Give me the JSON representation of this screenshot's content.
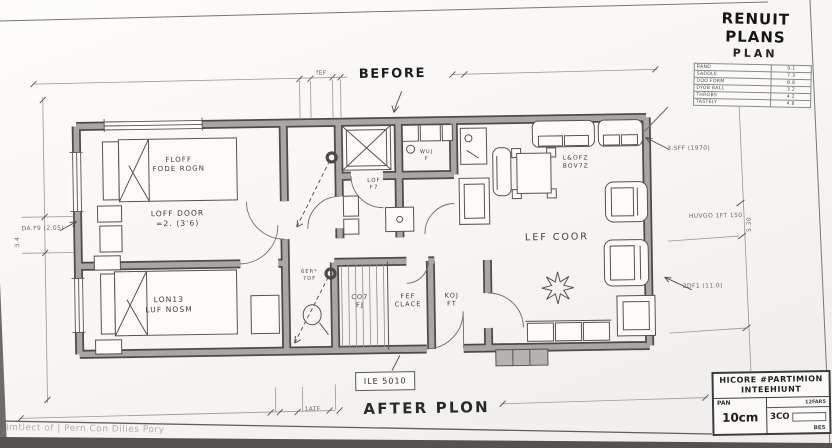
{
  "titles": {
    "before": "BEFORE",
    "after": "AFTER PLON"
  },
  "legend": {
    "title": "RENUIT PLANS",
    "subtitle": "PLAN",
    "rows": [
      {
        "label": "RAND",
        "value": "9.1"
      },
      {
        "label": "SADDLE",
        "value": "7.3"
      },
      {
        "label": "DOO FORM",
        "value": "8.8"
      },
      {
        "label": "DYOB BALL",
        "value": "3.2"
      },
      {
        "label": "THROBS",
        "value": "4.2"
      },
      {
        "label": "TASTELY",
        "value": "4.8"
      }
    ]
  },
  "rooms": {
    "bed1_furniture_l1": "FLOFF",
    "bed1_furniture_l2": "FODE ROGN",
    "bed1_name_l1": "LOFF DOOR",
    "bed1_name_l2": "=2. (3'6)",
    "bed2_name_l1": "LON13",
    "bed2_name_l2": "LUF NOSM",
    "living_furniture_l1": "L&OFZ",
    "living_furniture_l2": "BOV7Z",
    "living_name": "LEF COOR",
    "wc_l1": "LOF",
    "wc_l2": "F7",
    "kitchen_l1": "WUJ",
    "kitchen_l2": "F",
    "closet_small_l1": "6ER*",
    "closet_small_l2": "7DF",
    "wardrobe_l1": "CO7",
    "wardrobe_l2": "FJ",
    "fef_l1": "FEF",
    "fef_l2": "CLACE",
    "koj_l1": "KOJ",
    "koj_l2": "FT",
    "ile_tag": "ILE 5010"
  },
  "dimensions": {
    "top_small": "fEF",
    "bottom_small": "1ATF",
    "left_l1": "DA.F9",
    "left_l2": "(2.05)",
    "left_vertical": "3.4",
    "right_top_l1": "3.5FF",
    "right_top_l2": "(1970)",
    "right_mid_l1": "HUVGO",
    "right_mid_l2": "1FT 150",
    "right_vertical": "5.30",
    "right_bottom_l1": "2DF1",
    "right_bottom_l2": "(11.0)"
  },
  "title_block": {
    "name_l1": "HICORE #PARTIMION",
    "name_l2": "INTEEHIUNT",
    "scale_label": "PAN",
    "scale_value": "10cm",
    "ref": "12FAR5",
    "sheet": "3CO",
    "rev": "BE5"
  },
  "footer": {
    "credit": "Imtlect of | Pern Con Dilies Pory"
  },
  "colors": {
    "wall_fill": "#a9a7a3",
    "wall_edge": "#4c4b48",
    "ink": "#55544f",
    "dim": "#9a9894"
  }
}
